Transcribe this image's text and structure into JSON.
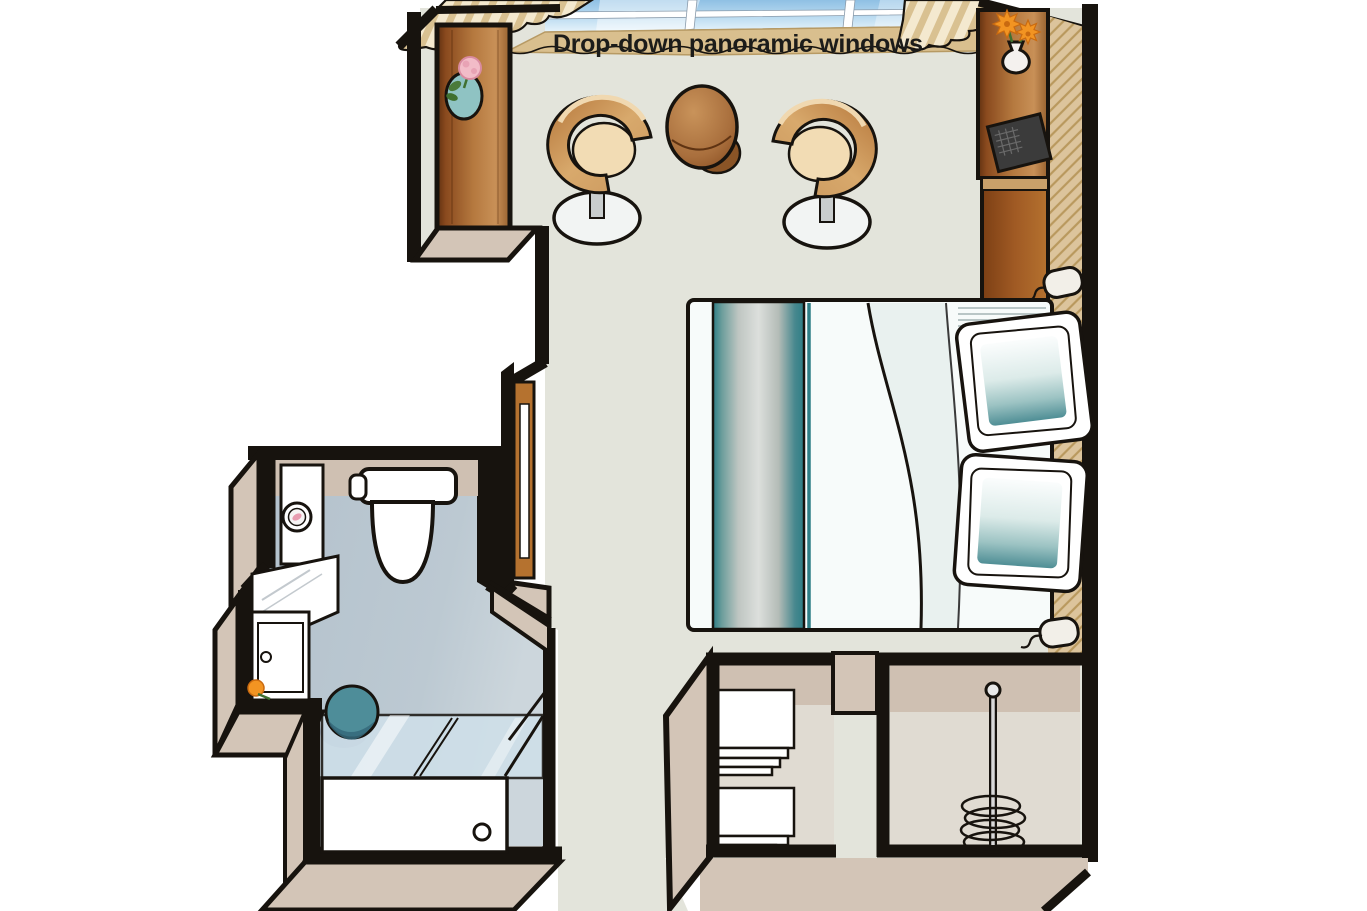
{
  "title": "Drop-down panoramic windows",
  "palette": {
    "outline": "#17130e",
    "wall_face": "#d3c5b7",
    "wall_face_dark": "#c7b8a9",
    "floor_main": "#e3e4db",
    "floor_bath_start": "#b3c1cc",
    "floor_bath_end": "#ccd6dc",
    "bath_wall_band": "#cfc0b2",
    "closet_back": "#cfc0b2",
    "closet_floor": "#e0dbd2",
    "glass_top": "#8fc0e4",
    "glass_bottom": "#e8f4fb",
    "sill": "#d9bf8e",
    "curtain_light": "#f4e9cf",
    "curtain_dark": "#d9c191",
    "wood_dark": "#5f3010",
    "wood_mid": "#b5793f",
    "wood_light": "#c89057",
    "door_brown": "#b5722f",
    "hatch_base": "#dcc49c",
    "hatch_line": "#b9995e",
    "chair_wood": "#c9965c",
    "chair_seat": "#f2dcb4",
    "table_wood": "#a96f3d",
    "table_shadow": "#8a5426",
    "runner_teal": "#2e7e86",
    "pillow_teal": "#4f8e95",
    "shower_teal": "#4e8d99",
    "shower_glass": "#cfe0ea",
    "lamp_white": "#f2efe8",
    "fixture_white": "#ffffff",
    "bed_white": "#f7fbfa",
    "flower_orange": "#f29422",
    "flower_pink": "#f2bcc8",
    "vase_teal": "#8fc3c3",
    "tv_dark": "#3b3b3b"
  },
  "furniture": {
    "window": "drop-down panoramic window",
    "curtains": "striped curtains",
    "armchairs": "two swivel tub chairs",
    "table": "round side table",
    "left_cabinet": "wood cabinet with flower vase",
    "right_cabinet": "desk / TV cabinet with flower vase",
    "bed": "double bed with teal runner and two pillows",
    "lamps": "two bedside lamps",
    "toilet": "toilet",
    "vanity": "washbasin vanity with mirror",
    "shower": "glass shower with tray",
    "entry_door": "cabin entry door",
    "closet_shelves": "wardrobe with folded linens",
    "closet_hangers": "wardrobe with clothes rail"
  }
}
